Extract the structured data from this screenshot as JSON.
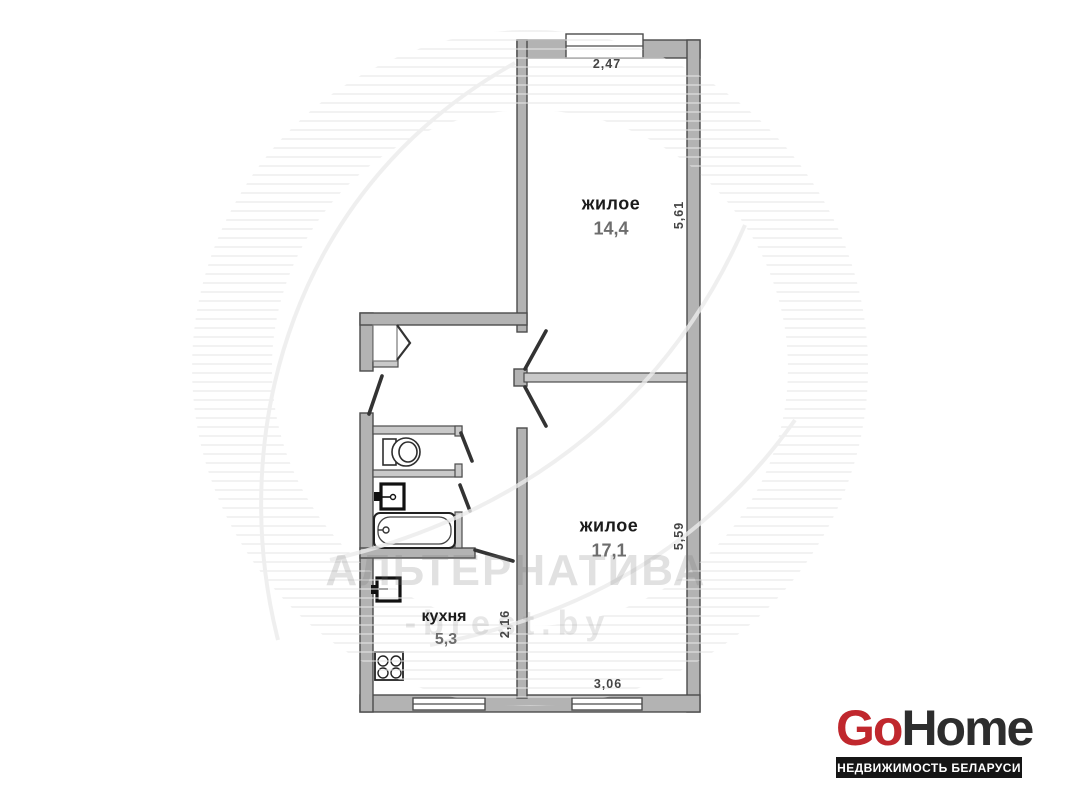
{
  "plan": {
    "rooms": [
      {
        "id": "living-1",
        "label": "жилое",
        "area": "14,4"
      },
      {
        "id": "living-2",
        "label": "жилое",
        "area": "17,1"
      },
      {
        "id": "kitchen",
        "label": "кухня",
        "area": "5,3"
      }
    ],
    "dimensions": {
      "living1_width": "2,47",
      "living1_depth": "5,61",
      "living2_depth": "5,59",
      "living2_width": "3,06",
      "kitchen_depth": "2,16"
    },
    "fixture_icons": [
      "closet-icon",
      "toilet-icon",
      "sink-icon",
      "bathtub-icon",
      "fridge-icon",
      "stove-icon",
      "window-icon"
    ]
  },
  "watermark": {
    "agency": "АЛЬТЕРНАТИВА",
    "website": "-brest.by"
  },
  "logo": {
    "part1": "Go",
    "part2": "Home",
    "tagline": "НЕДВИЖИМОСТЬ БЕЛАРУСИ"
  },
  "colors": {
    "logo_red": "#c0272d",
    "logo_dark": "#2d2d2d",
    "tagline_bar": "#151515",
    "wall_fill": "#b3b3b3",
    "wall_stroke": "#4c4c4c",
    "area_text": "#6d6d6d",
    "watermark_gray": "#e7e7e7"
  }
}
